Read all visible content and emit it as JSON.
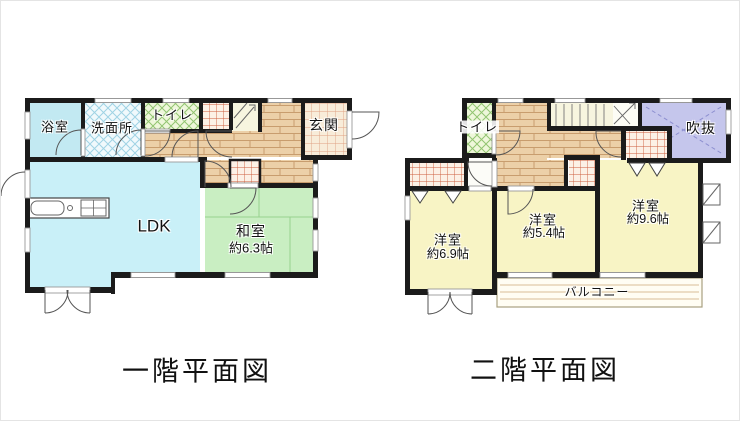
{
  "floor1": {
    "caption": "一階平面図",
    "rooms": {
      "bath": "浴室",
      "washroom": "洗面所",
      "toilet": "トイレ",
      "entrance": "玄関",
      "ldk": "LDK",
      "japanese_room": "和室",
      "japanese_room_size": "約6.3帖"
    }
  },
  "floor2": {
    "caption": "二階平面図",
    "rooms": {
      "toilet": "トイレ",
      "void": "吹抜",
      "bedroom1": "洋室",
      "bedroom1_size": "約6.9帖",
      "bedroom2": "洋室",
      "bedroom2_size": "約5.4帖",
      "bedroom3": "洋室",
      "bedroom3_size": "約9.6帖",
      "balcony": "バルコニー"
    }
  },
  "colors": {
    "wall": "#1b1b1b",
    "ldk_fill": "#c9f0f8",
    "bath_fill": "#c2e9f2",
    "washroom_crosshatch": "#9fd3e4",
    "toilet_crosshatch": "#92c571",
    "tatami_fill": "#c9eec2",
    "bedroom_fill": "#f8f4c5",
    "void_fill": "#c5c6ec",
    "wood_fill": "#ecd0a8",
    "tile_fill": "#f8ecd9",
    "closet_grid": "#cd5c3c",
    "stairs_fill": "#f7f5df"
  }
}
